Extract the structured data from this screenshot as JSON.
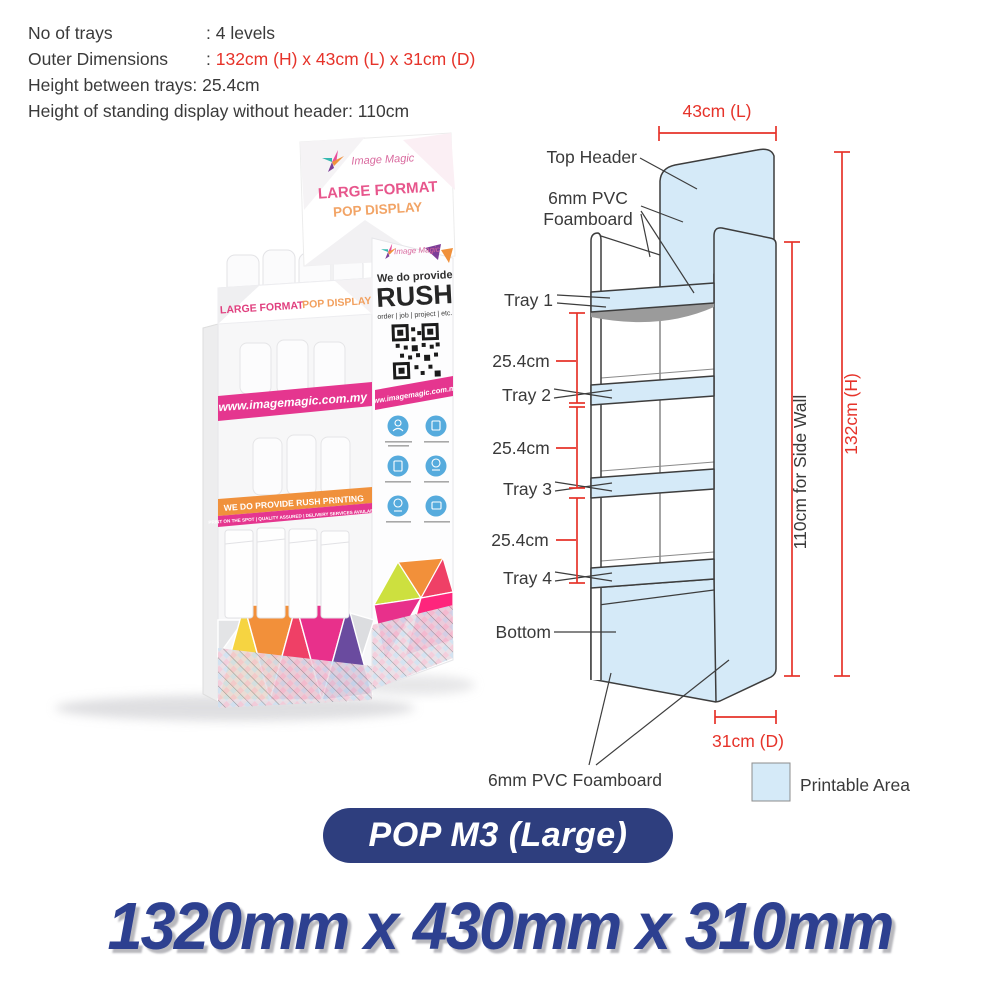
{
  "specs": {
    "no_of_trays_label": "No of trays",
    "no_of_trays_value": ": 4 levels",
    "outer_dim_label": "Outer Dimensions",
    "outer_dim_sep": ": ",
    "outer_dim_value": "132cm (H) x 43cm (L) x 31cm (D)",
    "tray_height_label": "Height between trays",
    "tray_height_value": ": 25.4cm",
    "standing_height_label": "Height of standing display without header",
    "standing_height_value": ": 110cm"
  },
  "diagram": {
    "width_dim": "43cm (L)",
    "height_dim": "132cm (H)",
    "side_wall_dim": "110cm for Side Wall",
    "depth_dim": "31cm (D)",
    "spacing_dim": "25.4cm",
    "labels": {
      "top_header": "Top Header",
      "foamboard_line1": "6mm PVC",
      "foamboard_line2": "Foamboard",
      "tray1": "Tray 1",
      "tray2": "Tray 2",
      "tray3": "Tray 3",
      "tray4": "Tray 4",
      "bottom": "Bottom",
      "foamboard_bottom": "6mm PVC Foamboard"
    },
    "legend": {
      "label": "Printable Area",
      "swatch_color": "#d5eaf8"
    }
  },
  "photo": {
    "brand": "Image Magic",
    "header": {
      "line1": "LARGE FORMAT",
      "line2": "POP DISPLAY"
    },
    "front_band": {
      "part1": "LARGE FORMAT",
      "part2": "POP DISPLAY"
    },
    "front_website": "www.imagemagic.com.my",
    "side": {
      "brand": "Image Magic",
      "rush_intro": "We do provide",
      "rush": "RUSH",
      "rush_sub": "order | job | project | etc.",
      "website": "www.imagemagic.com.my"
    },
    "orange_band": "WE DO PROVIDE RUSH PRINTING",
    "magenta_band": "PRINT ON THE SPOT | QUALITY ASSURED | DELIVERY SERVICES AVAILABLE"
  },
  "footer": {
    "model": "POP M3 (Large)",
    "dimensions": "1320mm x 430mm x 310mm"
  },
  "colors": {
    "dimension_red": "#e6332a",
    "printable_blue": "#d5eaf8",
    "navy": "#2e3e7e",
    "big_text_blue": "#2d4090",
    "magenta": "#e5368f",
    "orange": "#f0913c"
  }
}
